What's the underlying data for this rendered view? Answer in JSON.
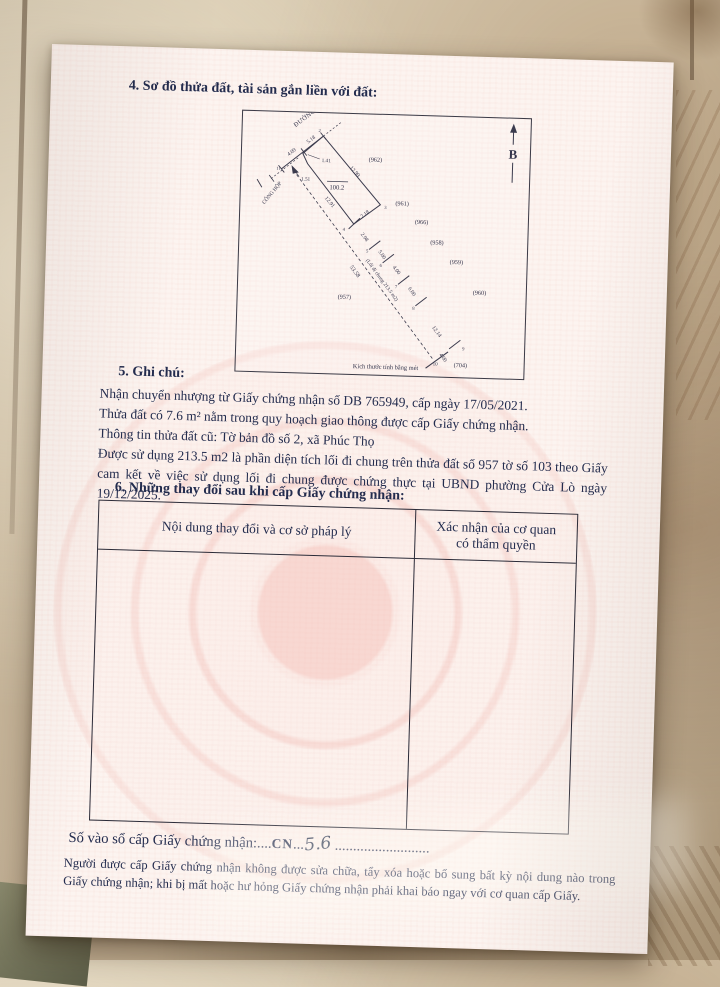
{
  "page": {
    "section4_title": "4. Sơ đồ thửa đất, tài sản gắn liền với đất:",
    "diagram": {
      "labels": {
        "north": "B",
        "road": "ĐƯỜNG",
        "culvert": "CỐNG HỘP",
        "v11": "11",
        "v2": "2",
        "v3": "3",
        "v4": "4",
        "v5": "5",
        "v6": "6",
        "v7": "7",
        "v8": "8",
        "v9": "9",
        "v10": "10",
        "d_409": "4.09",
        "d_518": "5.18",
        "d_141": "1.41",
        "d_151": "1.51",
        "d_1299": "12.99",
        "d_1291": "12.91",
        "d_218": "2.18",
        "d_298": "2.98",
        "d_500": "5.00",
        "d_400a": "4.00",
        "d_600": "6.00",
        "d_1214": "12.14",
        "d_400b": "4.00",
        "area": "100.2",
        "alley": "(Lối đi chung 213.5 m2)",
        "alley_total": "53.58",
        "n957": "(957)",
        "n958": "(958)",
        "n959": "(959)",
        "n960": "(960)",
        "n961": "(961)",
        "n962": "(962)",
        "n966": "(966)",
        "n704": "(704)",
        "caption": "Kích thước tính bằng mét"
      }
    },
    "section5": {
      "title": "5. Ghi chú:",
      "line1": "Nhận chuyển nhượng từ Giấy chứng nhận số DB 765949, cấp ngày 17/05/2021.",
      "line2": "Thửa đất có 7.6 m² nằm trong quy hoạch giao thông được cấp Giấy chứng nhận.",
      "line3": "Thông tin thửa đất cũ: Tờ bản đồ số 2, xã Phúc Thọ",
      "para": "Được sử dụng 213.5 m2 là phần diện tích lối đi chung trên thửa đất số 957 tờ số 103 theo Giấy cam kết về việc sử dụng lối đi chung được chứng thực tại UBND phường Cửa Lò ngày 19/12/2025."
    },
    "section6": {
      "title": "6. Những thay đổi sau khi cấp Giấy chứng nhận:",
      "col1_header": "Nội dung thay đổi và cơ sở pháp lý",
      "col2_header": "Xác nhận của cơ quan có thẩm quyền"
    },
    "registry": {
      "label": "Số vào sổ cấp Giấy chứng nhận:",
      "dots_a": "....",
      "code": "CN",
      "dots_b": "...",
      "number": "5.6",
      "dots_c": ".........................."
    },
    "footer_note": "Người được cấp Giấy chứng nhận không được sửa chữa, tẩy xóa hoặc bổ sung bất kỳ nội dung nào trong Giấy chứng nhận; khi bị mất hoặc hư hỏng Giấy chứng nhận phải khai báo ngay với cơ quan cấp Giấy."
  },
  "colors": {
    "ink": "#232c4e",
    "watermark_pink": "#f2bdb4",
    "floor_tan": "#cfbea2"
  }
}
